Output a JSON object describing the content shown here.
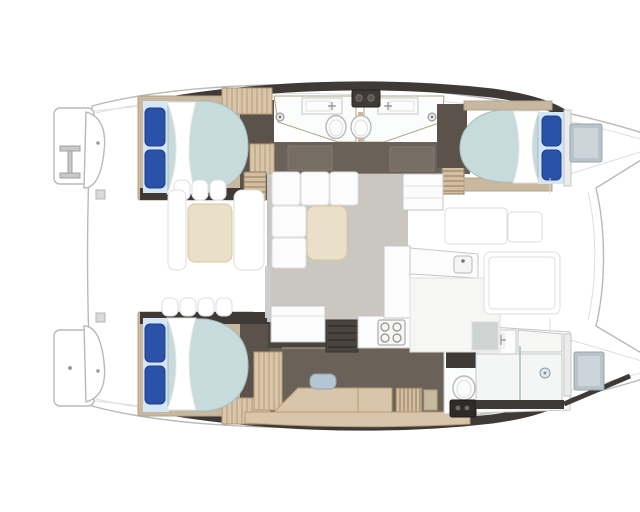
{
  "page": {
    "title": "Catamaran interior layout — top-down floor plan",
    "background": "#ffffff"
  },
  "colors": {
    "deck_white": "#ffffff",
    "hull_outline": "#b9b9b9",
    "hull_outline_light": "#dedede",
    "charcoal": "#3f3a35",
    "wall_charcoal": "#4a443f",
    "floor_dark": "#6a6158",
    "floor_dark2": "#5b534b",
    "door_panel": "#766d63",
    "wood_wall": "#c7b89f",
    "wood_wall_stroke": "#b2a489",
    "wood_floor": "#d9c6aa",
    "wood_floor_line": "#b49a79",
    "slat_wood": "#d3bf9f",
    "slat_line": "#8d7b61",
    "mattress": "#c7dadc",
    "mattress_stroke": "#a6babc",
    "pillow": "#2a52a8",
    "pillow_dark": "#1c3c8e",
    "pillow_back": "#d3e7f7",
    "duvet": "#ffffff",
    "salon_floor": "#cac7c1",
    "cream": "#eadfc8",
    "cream_stroke": "#d6c5a2",
    "counter": "#fcfcfc",
    "counter_soft": "#f6f6f4",
    "counter_stroke": "#c6c6c6",
    "fixture_stroke": "#8f8f8f",
    "hatch_gray": "#b9c3ca",
    "hatch_gray_light": "#ccd5d9",
    "appliance_black": "#2e2b28",
    "chair_blue": "#b6c5d2",
    "panel_gray": "#cfd3d2",
    "porcelain": "#fbfcfc",
    "shower_floor": "#f4f6f6",
    "glass": "#9fb6bd"
  },
  "vessel": {
    "kind": "catamaran floor plan, top-down view, bows pointing right",
    "areas": {
      "aft_deck": "aft cockpit with dining table, bench seating and steps",
      "salon": "salon with L-shaped sofa and ottoman table",
      "galley": "galley with cooktop, sink and counters",
      "port_hull": "port hull: two guest double cabins with two bathrooms amidships",
      "starboard_hull": "starboard hull: owner double cabin, desk area and forward shower bathroom",
      "foredeck": "foredeck between the bows with lounge pads"
    },
    "fixture_icons": [
      "double-bed",
      "pillow",
      "duvet",
      "toilet",
      "sink-faucet",
      "shower-head",
      "cooktop-burners",
      "washing-machine",
      "boarding-ladder",
      "bow-hatch",
      "companionway-steps",
      "desk-chair",
      "swim-platform"
    ]
  }
}
